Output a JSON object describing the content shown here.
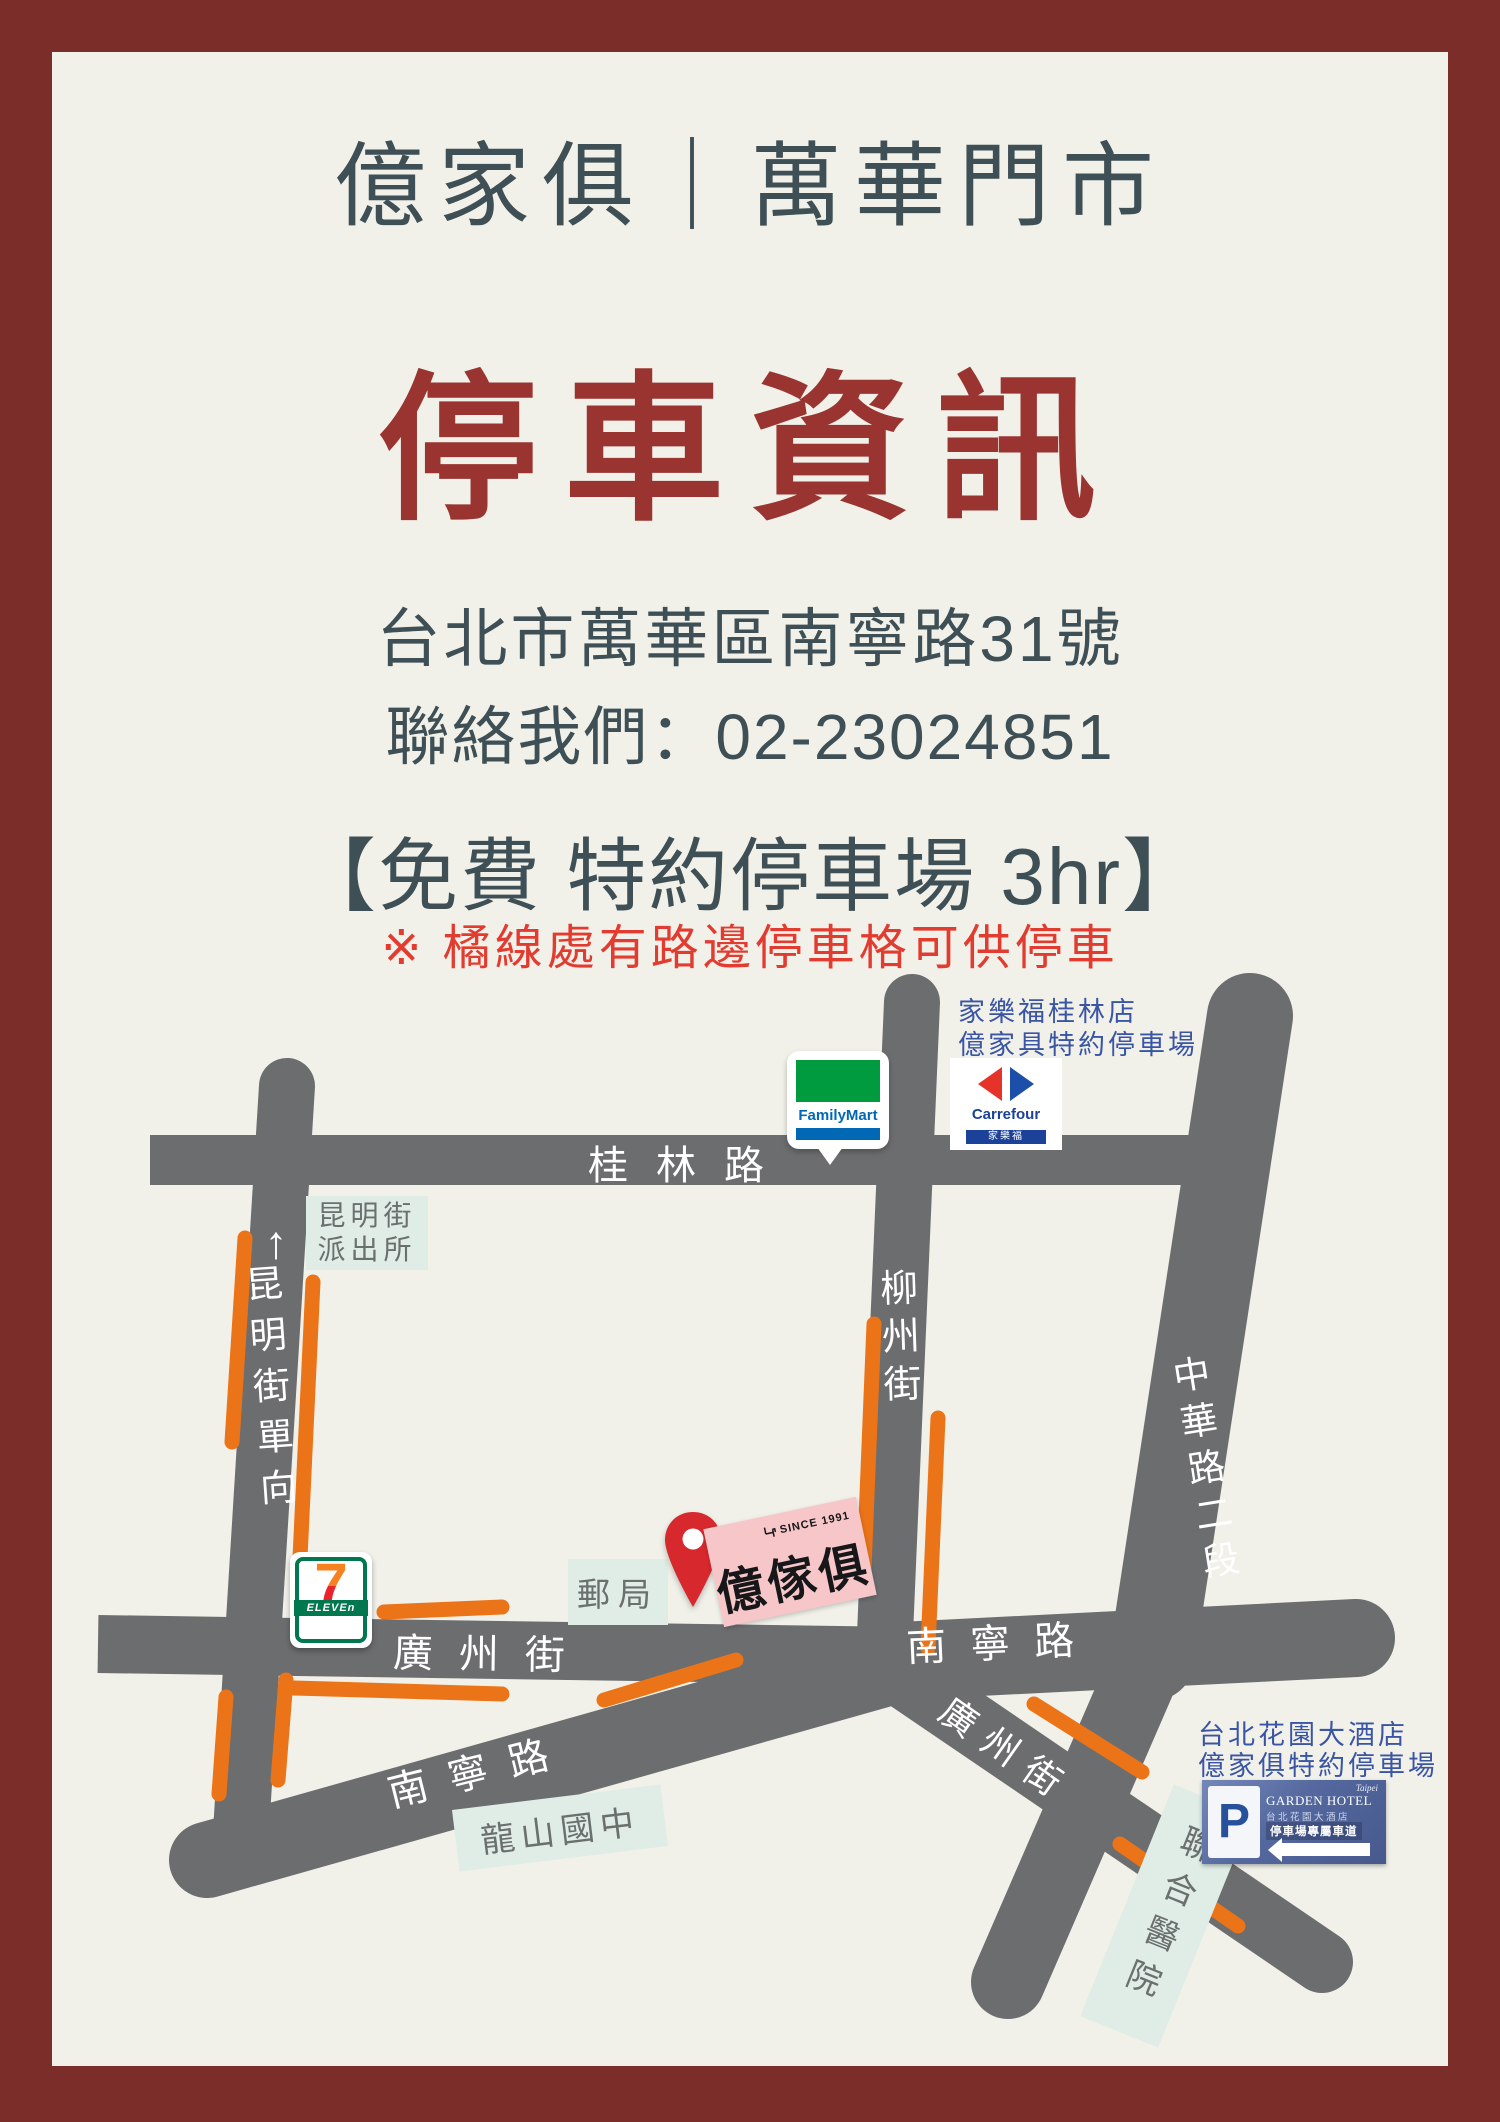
{
  "header": {
    "store_title": "億家俱｜萬華門市",
    "main_title": "停車資訊",
    "address": "台北市萬華區南寧路31號",
    "contact": "聯絡我們：02-23024851",
    "offer_heading": "【免費 特約停車場 3hr】",
    "note": "※ 橘線處有路邊停車格可供停車"
  },
  "map": {
    "streets": {
      "guilin_rd": "桂林路",
      "oneway_arrow": "↑",
      "kunming_st_oneway": "昆明街單向",
      "liuzhou_st": "柳州街",
      "zhonghua_rd_sec2": "中華路二段",
      "guangzhou_st_west": "廣州街",
      "nanning_rd_sw": "南寧路",
      "nanning_rd_east": "南寧路",
      "guangzhou_st_se": "廣州街"
    },
    "places": {
      "police_line1": "昆明街",
      "police_line2": "派出所",
      "post_office": "郵局",
      "longshan_junior_high": "龍山國中",
      "united_hospital": "聯合醫院"
    },
    "notes": {
      "carrefour_parking_line1": "家樂福桂林店",
      "carrefour_parking_line2": "億家具特約停車場",
      "hotel_parking_line1": "台北花園大酒店",
      "hotel_parking_line2": "億家俱特約停車場"
    },
    "logos": {
      "familymart": "FamilyMart",
      "seven": "7",
      "eleven": "ELEVEn",
      "carrefour": "Carrefour",
      "carrefour_zh": "家樂福",
      "store_name": "億傢俱",
      "store_since": "SINCE 1991",
      "hotel_p": "P",
      "hotel_city": "Taipei",
      "hotel_name": "GARDEN HOTEL",
      "hotel_name_zh": "台北花園大酒店",
      "hotel_lane": "停車場專屬車道"
    }
  },
  "colors": {
    "frame": "#7b2d29",
    "background": "#f1f1ea",
    "heading_dark": "#3e4f55",
    "title_red": "#9a3431",
    "note_red": "#e23c30",
    "road_gray": "#6c6d6f",
    "parking_orange": "#ec7418",
    "place_green": "#dfede6",
    "annotation_blue": "#3a55a4"
  }
}
